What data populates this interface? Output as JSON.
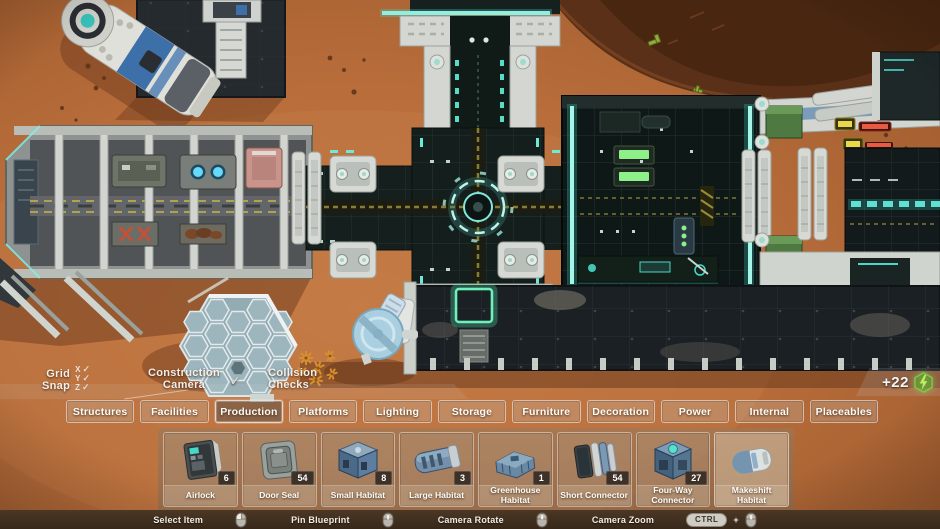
{
  "hud": {
    "check_glyph": "✓",
    "grid_snap": {
      "line1": "Grid",
      "line2": "Snap",
      "axes": [
        {
          "label": "X",
          "checked": true
        },
        {
          "label": "Y",
          "checked": true
        },
        {
          "label": "Z",
          "checked": true
        }
      ]
    },
    "construction_camera": {
      "line1": "Construction",
      "line2": "Camera",
      "checked": true
    },
    "collision_checks": {
      "line1": "Collision",
      "line2": "Checks",
      "checked": false
    },
    "energy": {
      "value": "+22",
      "icon": "lightning-icon"
    }
  },
  "tabs": [
    {
      "label": "Structures",
      "active": false
    },
    {
      "label": "Facilities",
      "active": false
    },
    {
      "label": "Production",
      "active": true
    },
    {
      "label": "Platforms",
      "active": false
    },
    {
      "label": "Lighting",
      "active": false
    },
    {
      "label": "Storage",
      "active": false
    },
    {
      "label": "Furniture",
      "active": false
    },
    {
      "label": "Decoration",
      "active": false
    },
    {
      "label": "Power",
      "active": false
    },
    {
      "label": "Internal",
      "active": false
    },
    {
      "label": "Placeables",
      "active": false
    }
  ],
  "items": [
    {
      "name": "Airlock",
      "count": "6",
      "icon": "airlock-icon",
      "highlighted": false
    },
    {
      "name": "Door Seal",
      "count": "54",
      "icon": "door-seal-icon",
      "highlighted": false
    },
    {
      "name": "Small Habitat",
      "count": "8",
      "icon": "small-habitat-icon",
      "highlighted": false
    },
    {
      "name": "Large Habitat",
      "count": "3",
      "icon": "large-habitat-icon",
      "highlighted": false
    },
    {
      "name": "Greenhouse Habitat",
      "count": "1",
      "icon": "greenhouse-habitat-icon",
      "highlighted": false
    },
    {
      "name": "Short Connector",
      "count": "54",
      "icon": "short-connector-icon",
      "highlighted": false
    },
    {
      "name": "Four-Way Connector",
      "count": "27",
      "icon": "four-way-connector-icon",
      "highlighted": false
    },
    {
      "name": "Makeshift Habitat",
      "count": null,
      "icon": "makeshift-habitat-icon",
      "highlighted": true
    }
  ],
  "hotkeys": [
    {
      "label": "Select Item",
      "icon": "mouse-left-icon",
      "mouse": "left"
    },
    {
      "label": "Pin Blueprint",
      "icon": "mouse-middle-icon",
      "mouse": "middle"
    },
    {
      "label": "Camera Rotate",
      "icon": "mouse-middle-icon",
      "mouse": "middle"
    },
    {
      "label": "Camera Zoom",
      "key": "CTRL",
      "plus": "+",
      "icon": "mouse-scroll-icon",
      "mouse": "scroll"
    }
  ],
  "colors": {
    "sand": "#b5693a",
    "panel_dark": "#1b2124",
    "glow_teal": "#6fe8d8",
    "glow_green": "#66e05a",
    "hazard_yellow": "#9a8c3a",
    "energy_green": "#b8f060",
    "frame_white": "#d6d9d3"
  }
}
